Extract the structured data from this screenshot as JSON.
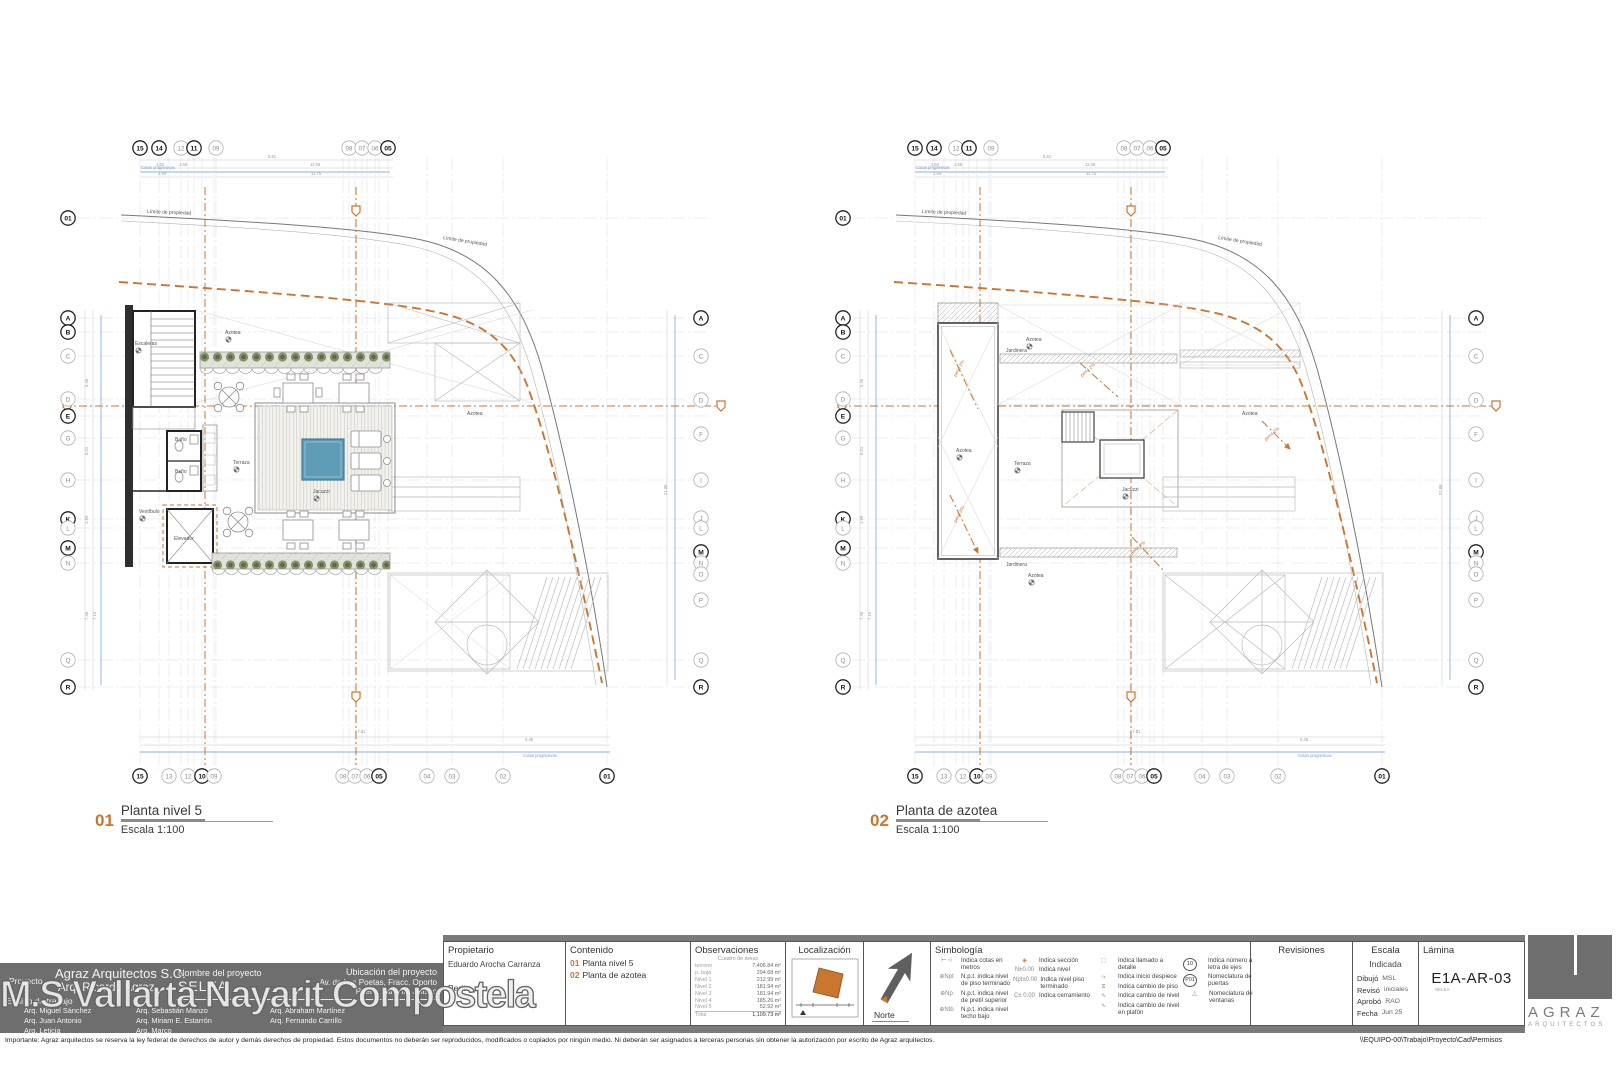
{
  "watermark": "M.S Vallarta Nayarit Compostela",
  "plans": {
    "grid": {
      "top": [
        {
          "l": "15",
          "p": 85,
          "b": true
        },
        {
          "l": "14",
          "p": 104,
          "b": true
        },
        {
          "l": "12",
          "p": 126,
          "b": false
        },
        {
          "l": "11",
          "p": 139,
          "b": true
        },
        {
          "l": "09",
          "p": 161,
          "b": false
        },
        {
          "l": "08",
          "p": 294,
          "b": false
        },
        {
          "l": "07",
          "p": 307,
          "b": false
        },
        {
          "l": "06",
          "p": 320,
          "b": false
        },
        {
          "l": "05",
          "p": 333,
          "b": true
        }
      ],
      "bottom": [
        {
          "l": "15",
          "p": 85,
          "b": true
        },
        {
          "l": "13",
          "p": 114,
          "b": false
        },
        {
          "l": "12",
          "p": 133,
          "b": false
        },
        {
          "l": "10",
          "p": 147,
          "b": true
        },
        {
          "l": "09",
          "p": 159,
          "b": false
        },
        {
          "l": "08",
          "p": 288,
          "b": false
        },
        {
          "l": "07",
          "p": 300,
          "b": false
        },
        {
          "l": "06",
          "p": 312,
          "b": false
        },
        {
          "l": "05",
          "p": 324,
          "b": true
        },
        {
          "l": "04",
          "p": 372,
          "b": false
        },
        {
          "l": "03",
          "p": 397,
          "b": false
        },
        {
          "l": "02",
          "p": 448,
          "b": false
        },
        {
          "l": "01",
          "p": 552,
          "b": true
        }
      ],
      "left": [
        {
          "l": "01",
          "p": 93,
          "b": true
        },
        {
          "l": "A",
          "p": 193,
          "b": true
        },
        {
          "l": "B",
          "p": 207,
          "b": true
        },
        {
          "l": "C",
          "p": 231,
          "b": false
        },
        {
          "l": "D",
          "p": 274,
          "b": false
        },
        {
          "l": "E",
          "p": 291,
          "b": true
        },
        {
          "l": "G",
          "p": 313,
          "b": false
        },
        {
          "l": "H",
          "p": 355,
          "b": false
        },
        {
          "l": "K",
          "p": 394,
          "b": true
        },
        {
          "l": "L",
          "p": 403,
          "b": false
        },
        {
          "l": "M",
          "p": 423,
          "b": true
        },
        {
          "l": "N",
          "p": 438,
          "b": false
        },
        {
          "l": "Q",
          "p": 535,
          "b": false
        },
        {
          "l": "R",
          "p": 562,
          "b": true
        }
      ],
      "right": [
        {
          "l": "A",
          "p": 193,
          "b": true
        },
        {
          "l": "C",
          "p": 231,
          "b": false
        },
        {
          "l": "D",
          "p": 275,
          "b": false
        },
        {
          "l": "F",
          "p": 309,
          "b": false
        },
        {
          "l": "I",
          "p": 355,
          "b": false
        },
        {
          "l": "J",
          "p": 393,
          "b": false
        },
        {
          "l": "L",
          "p": 403,
          "b": false
        },
        {
          "l": "M",
          "p": 427,
          "b": true
        },
        {
          "l": "N",
          "p": 438,
          "b": false
        },
        {
          "l": "O",
          "p": 449,
          "b": false
        },
        {
          "l": "P",
          "p": 475,
          "b": false
        },
        {
          "l": "Q",
          "p": 535,
          "b": false
        },
        {
          "l": "R",
          "p": 562,
          "b": true
        }
      ]
    },
    "dims": [
      {
        "t": "5.81",
        "x": 213,
        "y": 33
      },
      {
        "t": "1.52",
        "x": 101,
        "y": 41
      },
      {
        "t": "1.56",
        "x": 124,
        "y": 41
      },
      {
        "t": "11.06",
        "x": 255,
        "y": 41
      },
      {
        "t": "1.54",
        "x": 103,
        "y": 50
      },
      {
        "t": "11.75",
        "x": 256,
        "y": 50
      },
      {
        "t": "17.81",
        "x": 300,
        "y": 608
      },
      {
        "t": "0.45",
        "x": 470,
        "y": 616
      },
      {
        "t": "5.46",
        "x": 33,
        "y": 262,
        "r": -90
      },
      {
        "t": "6.01",
        "x": 33,
        "y": 330,
        "r": -90
      },
      {
        "t": "1.99",
        "x": 33,
        "y": 399,
        "r": -90
      },
      {
        "t": "7.46",
        "x": 33,
        "y": 495,
        "r": -90
      },
      {
        "t": "7.16",
        "x": 41,
        "y": 495,
        "r": -90
      },
      {
        "t": "21.88",
        "x": 612,
        "y": 370,
        "r": -90
      }
    ],
    "left": {
      "number": "01",
      "title": "Planta nivel 5",
      "scale": "Escala 1:100",
      "labels": [
        {
          "t": "Escaleras",
          "x": 80,
          "y": 220
        },
        {
          "t": "Azotea",
          "x": 170,
          "y": 209
        },
        {
          "t": "Azotea",
          "x": 412,
          "y": 290
        },
        {
          "t": "Terraza",
          "x": 178,
          "y": 339
        },
        {
          "t": "Jacuzzi",
          "x": 258,
          "y": 368
        },
        {
          "t": "Vestíbulo",
          "x": 84,
          "y": 388
        },
        {
          "t": "Elevador",
          "x": 119,
          "y": 415
        },
        {
          "t": "Baño",
          "x": 120,
          "y": 316
        },
        {
          "t": "Baño",
          "x": 120,
          "y": 348
        },
        {
          "t": "Límite de propiedad",
          "x": 92,
          "y": 88,
          "r": 2
        },
        {
          "t": "Límite de propiedad",
          "x": 388,
          "y": 114,
          "r": 9
        },
        {
          "t": "Cotas progresivas",
          "x": 86,
          "y": 44,
          "c": "blue"
        },
        {
          "t": "Cotas progresivas",
          "x": 468,
          "y": 632,
          "c": "blue"
        }
      ]
    },
    "right": {
      "number": "02",
      "title": "Planta de azotea",
      "scale": "Escala 1:100",
      "labels": [
        {
          "t": "Azotea",
          "x": 196,
          "y": 216
        },
        {
          "t": "Azotea",
          "x": 126,
          "y": 327
        },
        {
          "t": "Azotea",
          "x": 198,
          "y": 452
        },
        {
          "t": "Azotea",
          "x": 412,
          "y": 290
        },
        {
          "t": "Terraza",
          "x": 184,
          "y": 340
        },
        {
          "t": "Jacuzzi",
          "x": 292,
          "y": 366
        },
        {
          "t": "Jardinera",
          "x": 176,
          "y": 227
        },
        {
          "t": "Jardinera",
          "x": 176,
          "y": 441
        },
        {
          "t": "pend 2%",
          "x": 126,
          "y": 252,
          "r": -62,
          "c": "orange"
        },
        {
          "t": "pend 2%",
          "x": 126,
          "y": 398,
          "r": -62,
          "c": "orange"
        },
        {
          "t": "pend 2%",
          "x": 252,
          "y": 252,
          "r": -42,
          "c": "orange"
        },
        {
          "t": "pend 2%",
          "x": 302,
          "y": 430,
          "r": -42,
          "c": "orange"
        },
        {
          "t": "pend 2%",
          "x": 436,
          "y": 316,
          "r": -42,
          "c": "orange"
        },
        {
          "t": "Límite de propiedad",
          "x": 92,
          "y": 88,
          "r": 2
        },
        {
          "t": "Límite de propiedad",
          "x": 388,
          "y": 114,
          "r": 9
        },
        {
          "t": "Cotas progresivas",
          "x": 86,
          "y": 44,
          "c": "blue"
        },
        {
          "t": "Cotas progresivas",
          "x": 468,
          "y": 632,
          "c": "blue"
        }
      ]
    }
  },
  "titleblock": {
    "proyecto": {
      "label": "Proyecto",
      "firm": "Agraz Arquitectos S.C.",
      "architect": "Arq. Ricardo Agraz",
      "nombre_label": "Nombre del proyecto",
      "nombre": "SELEA",
      "ubicacion_label": "Ubicación del proyecto",
      "ubicacion1": "Av. de Los Poetas, Fracc. Oporto",
      "ubicacion2": "Puerto Vallarta, Jalisco"
    },
    "equipo": {
      "label": "Equipo de trabajo",
      "names": [
        [
          "Arq. Miguel Sánchez",
          "Arq. Sebastián Manzo",
          "Arq. Abraham Martínez"
        ],
        [
          "Arq. Juan Antonio",
          "Arq. Miriam E. Estarrón",
          "Arq. Fernando Carrillo"
        ],
        [
          "Arq. Leticia",
          "Arq. Marco",
          ""
        ]
      ]
    },
    "propietario": {
      "header": "Propietario",
      "owner": "Eduardo Arocha Carranza",
      "perito_label": "Perito"
    },
    "contenido": {
      "header": "Contenido",
      "items": [
        {
          "num": "01",
          "text": "Planta nivel 5"
        },
        {
          "num": "02",
          "text": "Planta de azotea"
        }
      ]
    },
    "observaciones": {
      "header": "Observaciones",
      "subheader": "Cuadro de áreas",
      "rows": [
        [
          "terreno",
          "7,406.84 m²"
        ],
        [
          "p. baja",
          "294.68 m²"
        ],
        [
          "Nivel 1",
          "212.99 m²"
        ],
        [
          "Nivel 2",
          "181.94 m²"
        ],
        [
          "Nivel 3",
          "181.94 m²"
        ],
        [
          "Nivel 4",
          "185.26 m²"
        ],
        [
          "Nivel 5",
          "52.92 m²"
        ],
        [
          "Total",
          "1,109.73 m²"
        ]
      ]
    },
    "localizacion": {
      "header": "Localización"
    },
    "norte": {
      "label": "Norte"
    },
    "simbologia": {
      "header": "Simbología",
      "col1": [
        {
          "sym": "dim",
          "text": "Indica cotas en metros"
        },
        {
          "sym": "npt",
          "text": "N.p.t. indica nivel de piso terminado"
        },
        {
          "sym": "np",
          "text": "N.p.t. indica nivel de pretil superior"
        },
        {
          "sym": "ntb",
          "text": "N.p.t. indica nivel techo bajo"
        }
      ],
      "col2": [
        {
          "sym": "section",
          "text": "Indica sección"
        },
        {
          "sym": "lvl",
          "text": "Indica nivel"
        },
        {
          "sym": "lvlpt",
          "text": "Indica nivel piso terminado"
        },
        {
          "sym": "cerr",
          "text": "Indica cerramiento"
        }
      ],
      "col3": [
        {
          "sym": "detail",
          "text": "Indica llamado a detalle"
        },
        {
          "sym": "despiece",
          "text": "Indica inicio despiece"
        },
        {
          "sym": "piso",
          "text": "Indica cambio de piso"
        },
        {
          "sym": "nivel",
          "text": "Indica cambio de nivel"
        },
        {
          "sym": "plafon",
          "text": "Indica cambio de nivel en plafón"
        }
      ],
      "col4": [
        {
          "sym": "c10",
          "text": "Indica número a letra de ejes"
        },
        {
          "sym": "p01",
          "text": "Nomeclatura de puertas"
        },
        {
          "sym": "tri",
          "text": "Nomeclatura de ventanas"
        }
      ]
    },
    "revisiones": {
      "header": "Revisiones"
    },
    "escala": {
      "header": "Escala",
      "value": "Indicada",
      "dibujo_label": "Dibujó",
      "dibujo": "MSL",
      "reviso_label": "Revisó",
      "reviso": "iniciales",
      "aprobo_label": "Aprobó",
      "aprobo": "RAO",
      "fecha_label": "Fecha",
      "fecha": "Jun 25"
    },
    "lamina": {
      "header": "Lámina",
      "value": "E1A-AR-03",
      "sub": "SELEA"
    },
    "logo": {
      "name": "AGRAZ",
      "sub": "ARQUITECTOS"
    }
  },
  "footer": {
    "disclaimer": "Importante: Agraz arquitectos se reserva la ley federal de derechos de autor y demás derechos de propiedad. Estos documentos no deberán ser reproducidos, modificados o copiados por ningún medio. Ni deberán ser asignados a terceras personas sin obtener la autorización por escrito de Agraz arquitectos.",
    "path": "\\\\EQUIPO-00\\Trabajo\\Proyecto\\Cad\\Permisos"
  }
}
